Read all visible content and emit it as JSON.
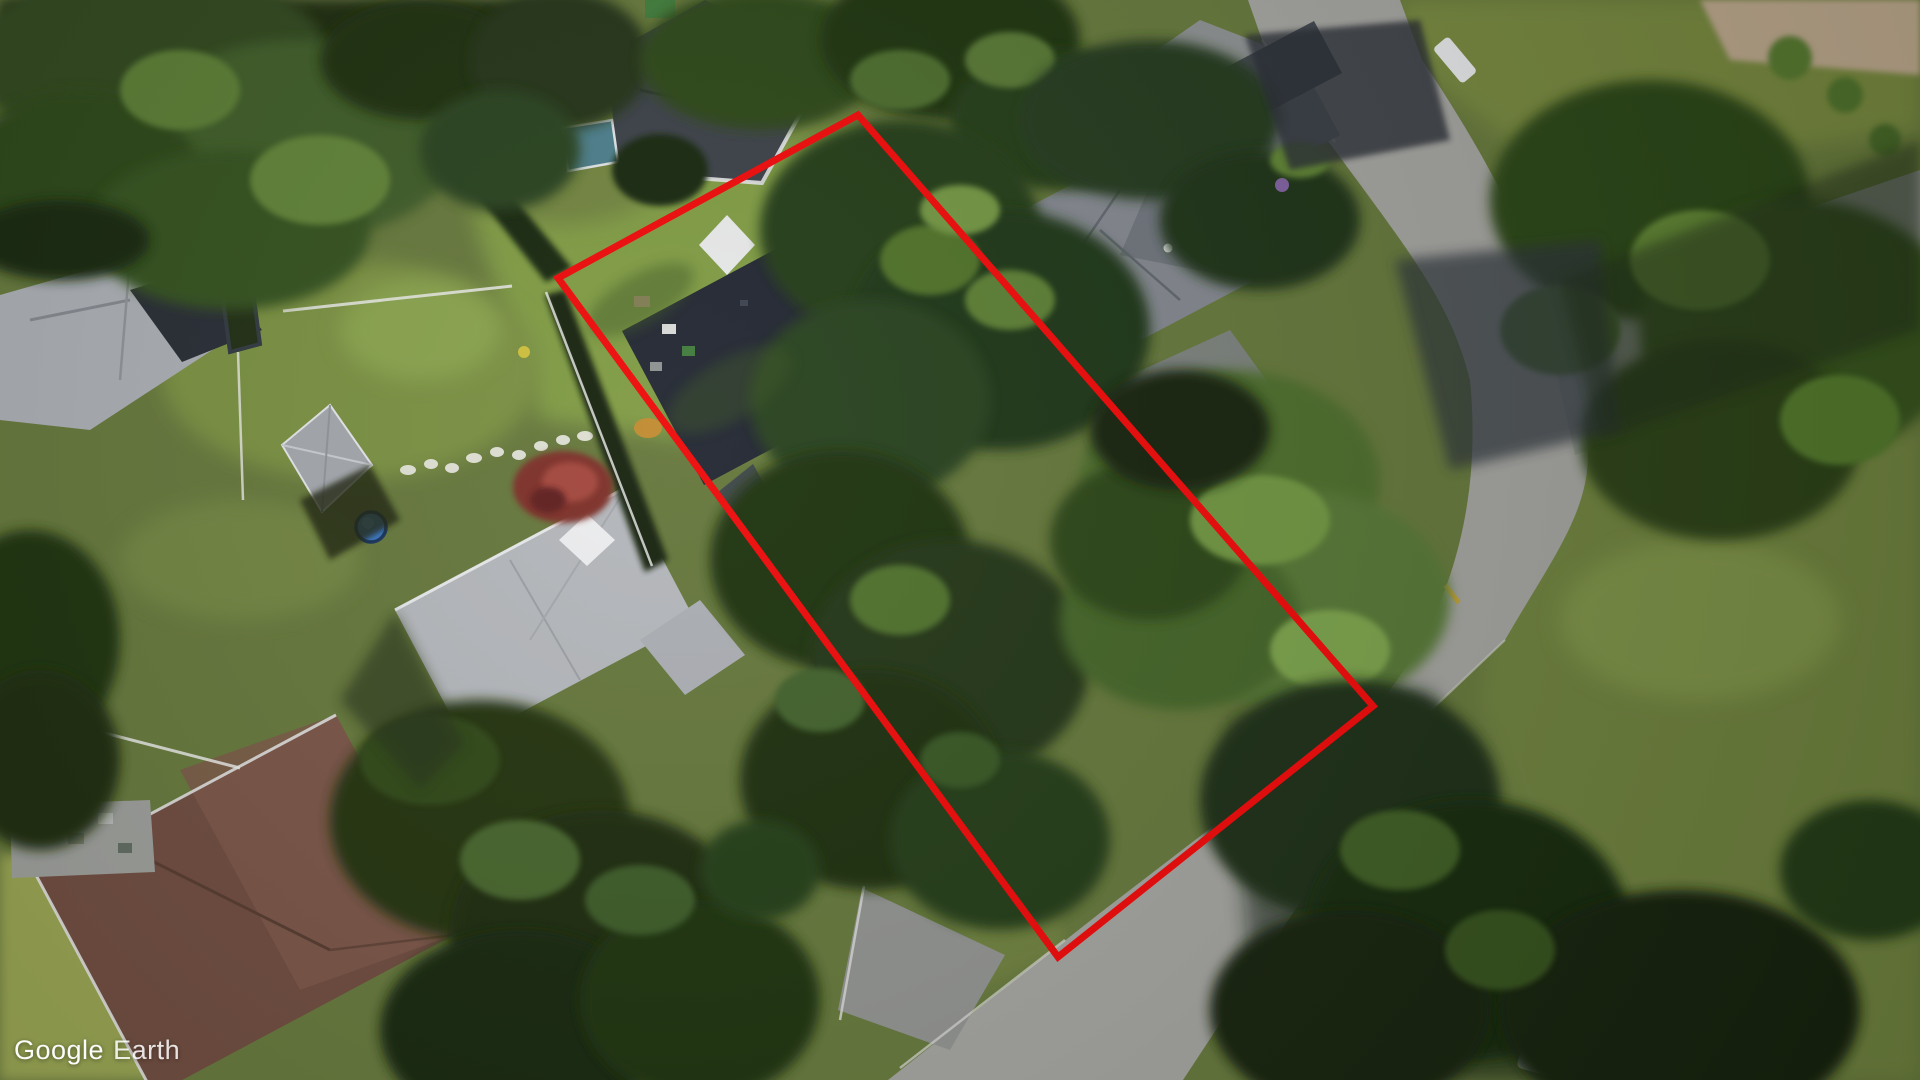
{
  "app": {
    "name": "Google Earth aerial view"
  },
  "watermark": {
    "brand": "Google",
    "product": "Earth",
    "color": "#ffffff"
  },
  "overlay": {
    "property_outline": {
      "points": "558,278 858,115 1373,706 1058,957",
      "color": "#ee0808",
      "stroke_width": "7"
    }
  },
  "scene": {
    "type": "satellite-aerial-residential",
    "features": [
      {
        "name": "highlighted-property-boundary",
        "color": "#ee0808"
      },
      {
        "name": "subject-house-dark-flat-roof",
        "color": "#202530"
      },
      {
        "name": "white-patio-canopies",
        "color": "#e7e8e8"
      },
      {
        "name": "neighbor-house-gray-hip-roof",
        "color": "#81858c"
      },
      {
        "name": "light-gray-roof-house",
        "color": "#b3b6ba"
      },
      {
        "name": "pyramid-roof-garage",
        "color": "#a2a6ab"
      },
      {
        "name": "brown-hip-roof-house",
        "color": "#6d4a3d"
      },
      {
        "name": "white-dark-roof-house",
        "color": "#3a3f46"
      },
      {
        "name": "teal-garden-shed",
        "color": "#4b7d8a"
      },
      {
        "name": "street-pavement",
        "color": "#a1a19d"
      },
      {
        "name": "driveways",
        "color": "#8f918e"
      },
      {
        "name": "lawns",
        "color": "#7e9a43"
      },
      {
        "name": "tree-canopy",
        "color": "#233a15"
      },
      {
        "name": "japanese-maple-tree",
        "color": "#7c2e28"
      },
      {
        "name": "backyard-pool",
        "color": "#3a78c8"
      },
      {
        "name": "stepping-stone-path",
        "color": "#e9e8e0"
      },
      {
        "name": "road-centerline-dash",
        "color": "#c2a038"
      }
    ]
  }
}
